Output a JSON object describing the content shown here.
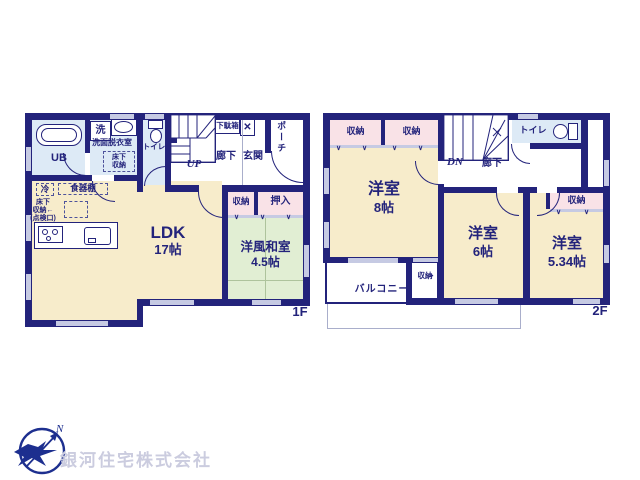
{
  "palette": {
    "wall": "#23237b",
    "room_cream": "#f7eccb",
    "wet_area_blue": "#ddeaf6",
    "tatami_green": "#e1eed3",
    "closet_pink": "#f9e2e7",
    "opening_lavender": "#c6cae3",
    "logo_navy": "#1d2f8f",
    "company_text": "#cbccdf"
  },
  "floor1": {
    "label": "1F",
    "ldk": {
      "name": "LDK",
      "size": "17帖"
    },
    "tatami_room": {
      "name": "洋風和室",
      "size": "4.5帖"
    },
    "bath": "UB",
    "washer": "洗",
    "washroom": "洗面脱衣室",
    "toilet": "トイレ",
    "corridor": "廊下",
    "entrance": "玄関",
    "porch": "ポーチ",
    "shoe_cabinet": "下駄箱",
    "storage": "収納",
    "closet": "押入",
    "stairs": "UP",
    "fridge": "冷",
    "cupboard": "食器棚",
    "underfloor": {
      "line1": "床下",
      "line2": "収納",
      "line3": "(点検口)"
    }
  },
  "floor2": {
    "label": "2F",
    "bedroom8": {
      "name": "洋室",
      "size": "8帖"
    },
    "bedroom6": {
      "name": "洋室",
      "size": "6帖"
    },
    "bedroom5": {
      "name": "洋室",
      "size": "5.34帖"
    },
    "toilet": "トイレ",
    "corridor": "廊下",
    "storage": "収納",
    "balcony": "バルコニー",
    "stairs": "DN"
  },
  "footer": {
    "company": "銀河住宅株式会社",
    "compass": "N"
  },
  "icons": {
    "chevron_down": "∨",
    "cross_mark": "✕",
    "arrow": "←"
  }
}
